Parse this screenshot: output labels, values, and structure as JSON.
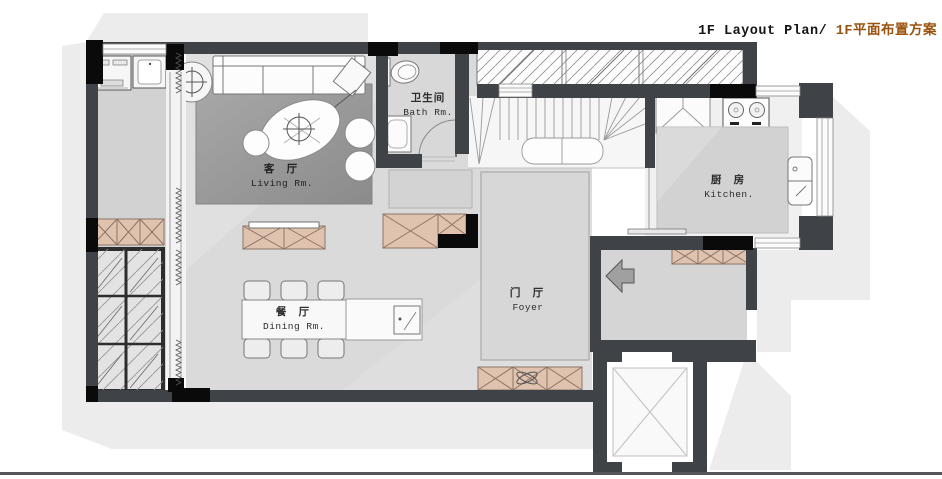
{
  "title": {
    "left": "1F Layout Plan/ ",
    "right": "1F平面布置方案"
  },
  "rooms": {
    "living": {
      "zh": "客 厅",
      "en": "Living Rm."
    },
    "bath": {
      "zh": "卫生间",
      "en": "Bath Rm."
    },
    "kitchen": {
      "zh": "厨 房",
      "en": "Kitchen."
    },
    "dining": {
      "zh": "餐 厅",
      "en": "Dining Rm."
    },
    "foyer": {
      "zh": "门 厅",
      "en": "Foyer"
    }
  },
  "colors": {
    "accent": "#9a520f",
    "wall": "#3f4246",
    "column": "#0a0a0a",
    "cabinet_tan": "#dfc3ae",
    "cabinet_border": "#8c7468",
    "shadow": "#ececec",
    "rug": "#979797",
    "footer_line": "#54565a"
  }
}
